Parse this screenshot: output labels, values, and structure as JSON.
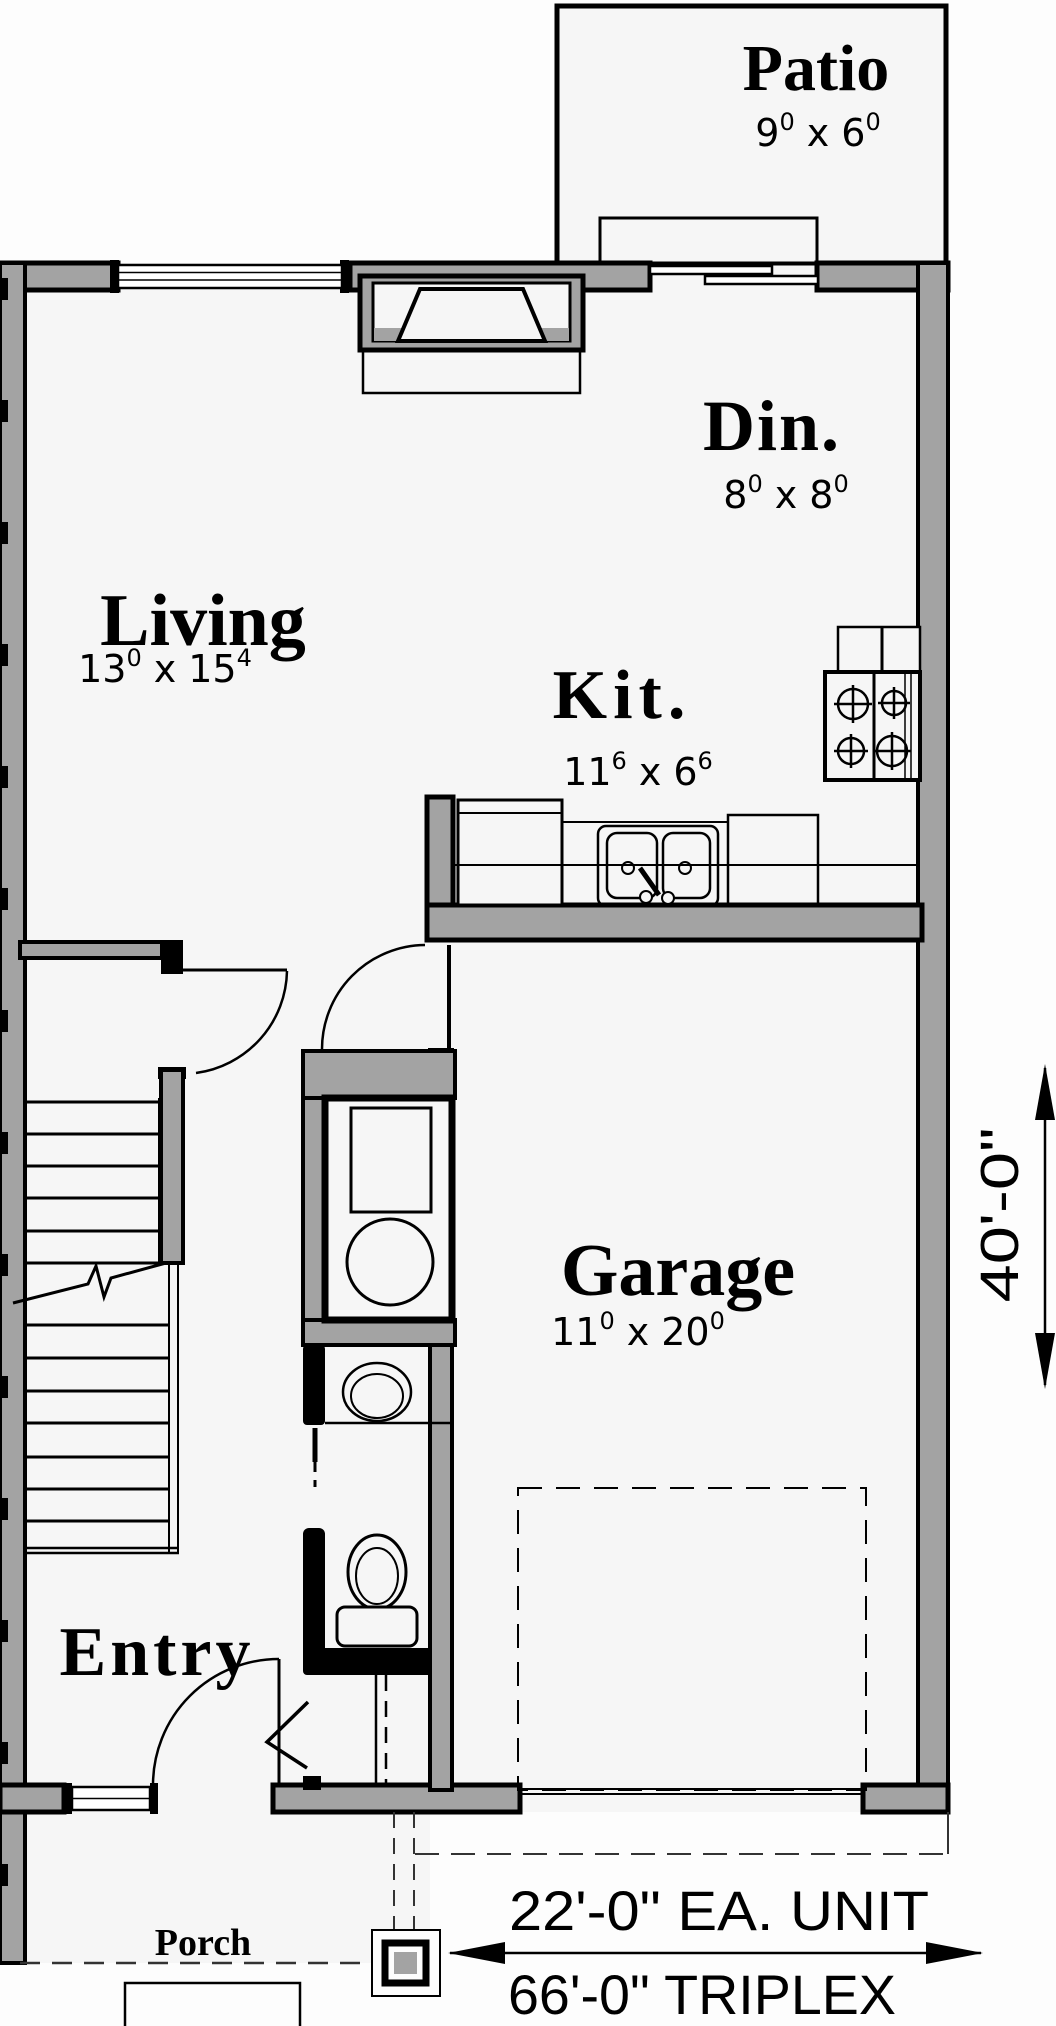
{
  "rooms": {
    "patio": {
      "label": "Patio",
      "dim": {
        "a": "9",
        "a_sup": "0",
        "sep": "x",
        "b": "6",
        "b_sup": "0"
      }
    },
    "dining": {
      "label": "Din.",
      "dim": {
        "a": "8",
        "a_sup": "0",
        "sep": "x",
        "b": "8",
        "b_sup": "0"
      }
    },
    "living": {
      "label": "Living",
      "dim": {
        "a": "13",
        "a_sup": "0",
        "sep": "x",
        "b": "15",
        "b_sup": "4"
      }
    },
    "kitchen": {
      "label": "Kit.",
      "dim": {
        "a": "11",
        "a_sup": "6",
        "sep": "x",
        "b": "6",
        "b_sup": "6"
      }
    },
    "garage": {
      "label": "Garage",
      "dim": {
        "a": "11",
        "a_sup": "0",
        "sep": "x",
        "b": "20",
        "b_sup": "0"
      }
    },
    "entry": {
      "label": "Entry"
    },
    "porch": {
      "label": "Porch"
    }
  },
  "dimensions": {
    "height_annotation": "40'-0\"",
    "unit_width_annotation": "22'-0\" EA. UNIT",
    "total_width_annotation": "66'-0\" TRIPLEX"
  },
  "icons": {
    "fixtures": [
      "fireplace",
      "window",
      "sliding-patio-door",
      "kitchen-range",
      "refrigerator",
      "kitchen-sink",
      "dishwasher",
      "furnace",
      "water-heater",
      "vanity-sink",
      "toilet",
      "staircase",
      "door-swing-arc",
      "garage-door-dashed",
      "porch-column",
      "porch-step",
      "dimension-arrow"
    ]
  },
  "colors": {
    "wall_fill": "#a3a3a3",
    "line": "#000000",
    "floor": "#f6f6f6",
    "paper": "#fdfdfd"
  }
}
